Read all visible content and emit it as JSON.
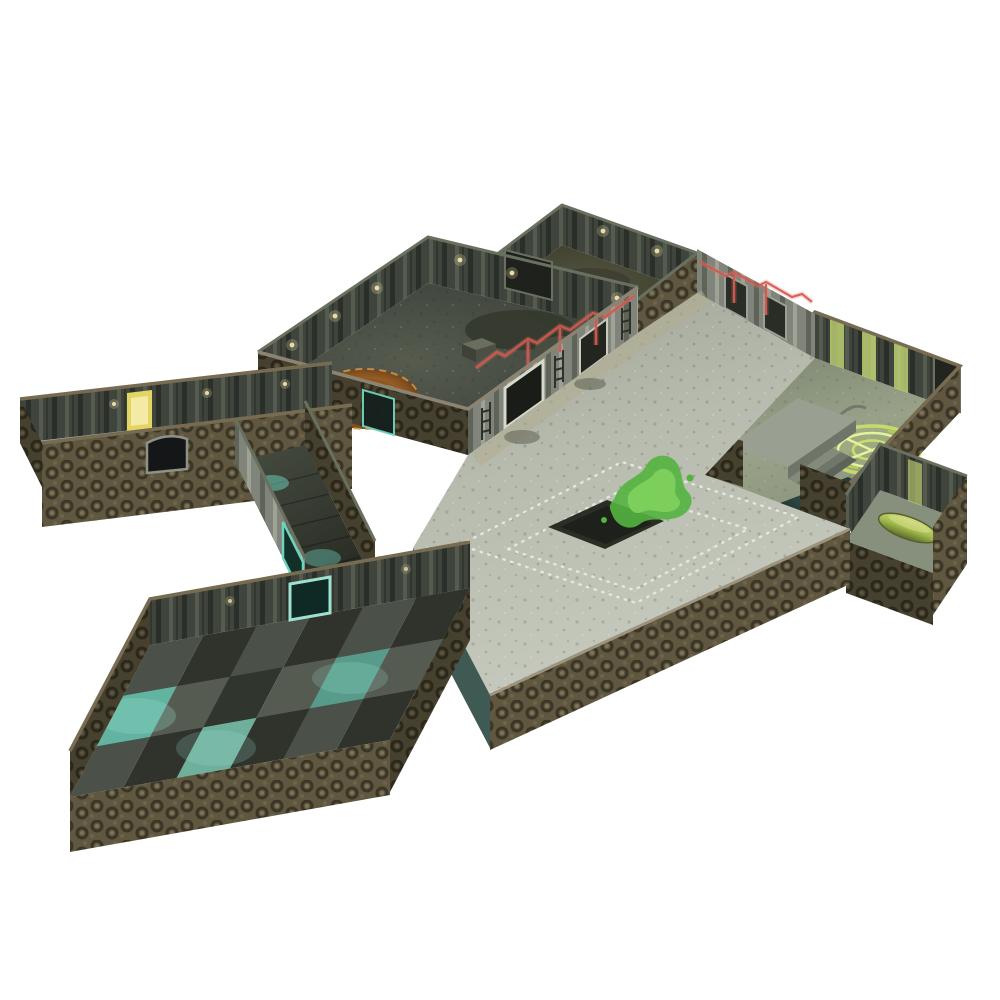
{
  "canvas": {
    "width": 1000,
    "height": 1000,
    "background": "#ffffff"
  },
  "scene": {
    "subject": "isometric-modular-scifi-dungeon-terrain-set",
    "modules": [
      {
        "name": "top-storage-room",
        "floor": "dark-grunge"
      },
      {
        "name": "machine-room",
        "floor": "dark-industrial",
        "feature": "orange-circular-hatch"
      },
      {
        "name": "left-wing-corridor",
        "floor": "grey",
        "feature": "yellow-lit-door"
      },
      {
        "name": "junction-corridor",
        "floor": "dark",
        "feature": "teal-glow-tiles"
      },
      {
        "name": "sigil-room",
        "floor": "green-grey",
        "feature": "green-glowing-sigil"
      },
      {
        "name": "capsule-alcove",
        "floor": "green-grey",
        "feature": "green-capsule"
      },
      {
        "name": "great-hall-plaza",
        "floor": "light-grey-riveted",
        "feature": "green-slime-splat"
      },
      {
        "name": "checker-vault-room",
        "floor": "checkered",
        "feature": "teal-glow-tiles"
      }
    ]
  },
  "colors": {
    "background": "#ffffff",
    "wallExterior": "#5f5740",
    "wallExteriorDark": "#46402e",
    "wallInterior": "#3f443c",
    "wallInteriorLit": "#87897c",
    "wallCap": "#776c52",
    "plaza": "#b4b8ac",
    "plazaBand": "#b3ad91",
    "recess": "#2b2e27",
    "floorDark": "#43473d",
    "floorWing": "#9aa092",
    "checkerA": "#4b5148",
    "checkerB": "#2f332c",
    "tealGlow": "#6fd3bd",
    "tealDeep": "#3e5a52",
    "orangeRing": "#b06a2c",
    "sigilGreen": "#c8e06a",
    "slimeGreen": "#53b43f",
    "redConduit": "#d4574e",
    "yellowDoor": "#e3d563",
    "lampWarm": "#e9dca6",
    "copper": "#a97844",
    "poolDark": "#23352f",
    "capsuleGreen": "#9fb84a",
    "rivetDot": "#e4e7dc",
    "doorDark": "#23261f",
    "doorTrim": "#d6d8cc"
  }
}
